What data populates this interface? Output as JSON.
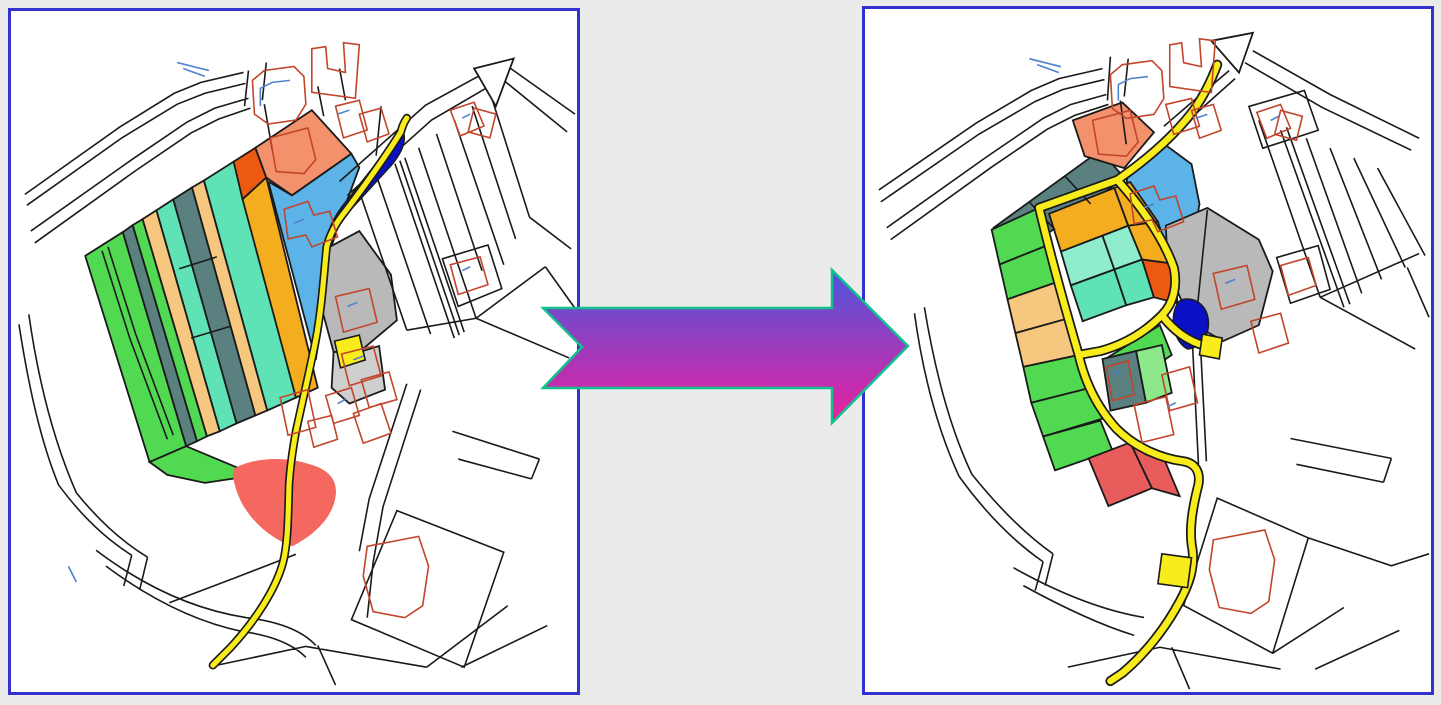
{
  "page": {
    "background": "#ebebeb"
  },
  "panels": {
    "before": {
      "background": "#ffffff",
      "border_color": "#3431cd"
    },
    "after": {
      "background": "#ffffff",
      "border_color": "#3431cd"
    }
  },
  "arrow": {
    "gradient_top": "#4b57dc",
    "gradient_bottom": "#ec1f9e",
    "outline": "#12c28e"
  },
  "palette": {
    "outline": "#1a1a1a",
    "building": "#c2452c",
    "building_blue": "#4d83cf",
    "road_yellow": "#f8ec1c",
    "water_blue": "#0a10c4",
    "green_bright": "#52d952",
    "green_light": "#8ce88a",
    "slate_teal": "#5a8080",
    "peach": "#f6c77e",
    "turquoise": "#5fe2b6",
    "turquoise_light": "#8feccd",
    "gold": "#f3ad1f",
    "orange_red": "#eb5a10",
    "salmon": "#f2916b",
    "sky_blue": "#5cb3e8",
    "gray_parcel": "#b9b9b9",
    "gray_light": "#cfcfcf",
    "pink_red": "#f5685f",
    "red_parcel": "#e85c5c",
    "white": "#ffffff"
  }
}
